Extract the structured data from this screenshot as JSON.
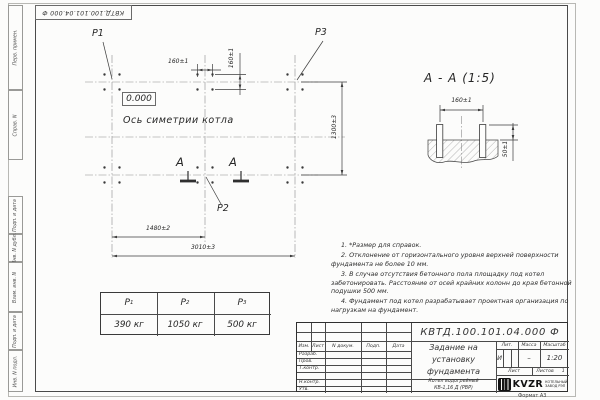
{
  "sheet": {
    "doc_number": "КВТД.100.101.04.000 Ф",
    "doc_number_top": "КВТД.100.101.04.000 Ф",
    "format_label": "Формат А3"
  },
  "margin_labels": {
    "perv": "Перв. примен.",
    "sprav": "Справ. N",
    "podp1": "Подп. и дата",
    "inv_dubl": "Инв. N дубл.",
    "vzam": "Взам. инв. N",
    "podp2": "Подп. и дата",
    "inv_podl": "Инв. N подл."
  },
  "plan": {
    "p1": "Р1",
    "p2": "Р2",
    "p3": "Р3",
    "elevation": "0.000",
    "axis_label": "Ось симетрии котла",
    "section_letter_left": "А",
    "section_letter_right": "А",
    "dim_bolt_h": "160±1",
    "dim_bolt_v": "160±1",
    "dim_height": "1300±3",
    "dim_mid": "1480±2",
    "dim_total": "3010±3"
  },
  "section_view": {
    "title": "А - А (1:5)",
    "dim_spacing": "160±1",
    "dim_protrusion": "50±1"
  },
  "load_table": {
    "headers": [
      {
        "name": "Р",
        "sub": "1"
      },
      {
        "name": "Р",
        "sub": "2"
      },
      {
        "name": "Р",
        "sub": "3"
      }
    ],
    "values": [
      "390 кг",
      "1050 кг",
      "500 кг"
    ]
  },
  "notes": [
    "1. *Размер для справок.",
    "2. Отклонение от горизонтального уровня верхней поверхности фундамента не более 10 мм.",
    "3. В случае отсутствия бетонного пола площадку под котел забетонировать. Расстояние от осей крайних колонн до края бетонной подушки 500 мм.",
    "4. Фундамент под котел разрабатывает проектная организация по нагрузкам на фундамент."
  ],
  "title_block": {
    "title_line1": "Задание на",
    "title_line2": "установку",
    "title_line3": "фундамента",
    "product_line1": "Котел водогрейный",
    "product_line2": "КВ-1,16 Д (РВР)",
    "rev_headers": {
      "izm": "Изм.",
      "list": "Лист",
      "doc": "N докум.",
      "podp": "Подп.",
      "data": "Дата"
    },
    "roles": {
      "razrab": "Разраб.",
      "prov": "Пров.",
      "tkontr": "Т.контр.",
      "nkontr": "Н.контр.",
      "utv": "Утв."
    },
    "lit_header": "Лит.",
    "mass_header": "Масса",
    "scale_header": "Масштаб",
    "lit_value": "И",
    "mass_value": "–",
    "scale_value": "1:20",
    "sheet_label": "Лист",
    "sheets_label": "Листов",
    "sheets_value": "1",
    "logo_text": "KVZR",
    "logo_sub1": "КОТЕЛЬНЫЙ",
    "logo_sub2": "ЗАВОД РЭП"
  }
}
